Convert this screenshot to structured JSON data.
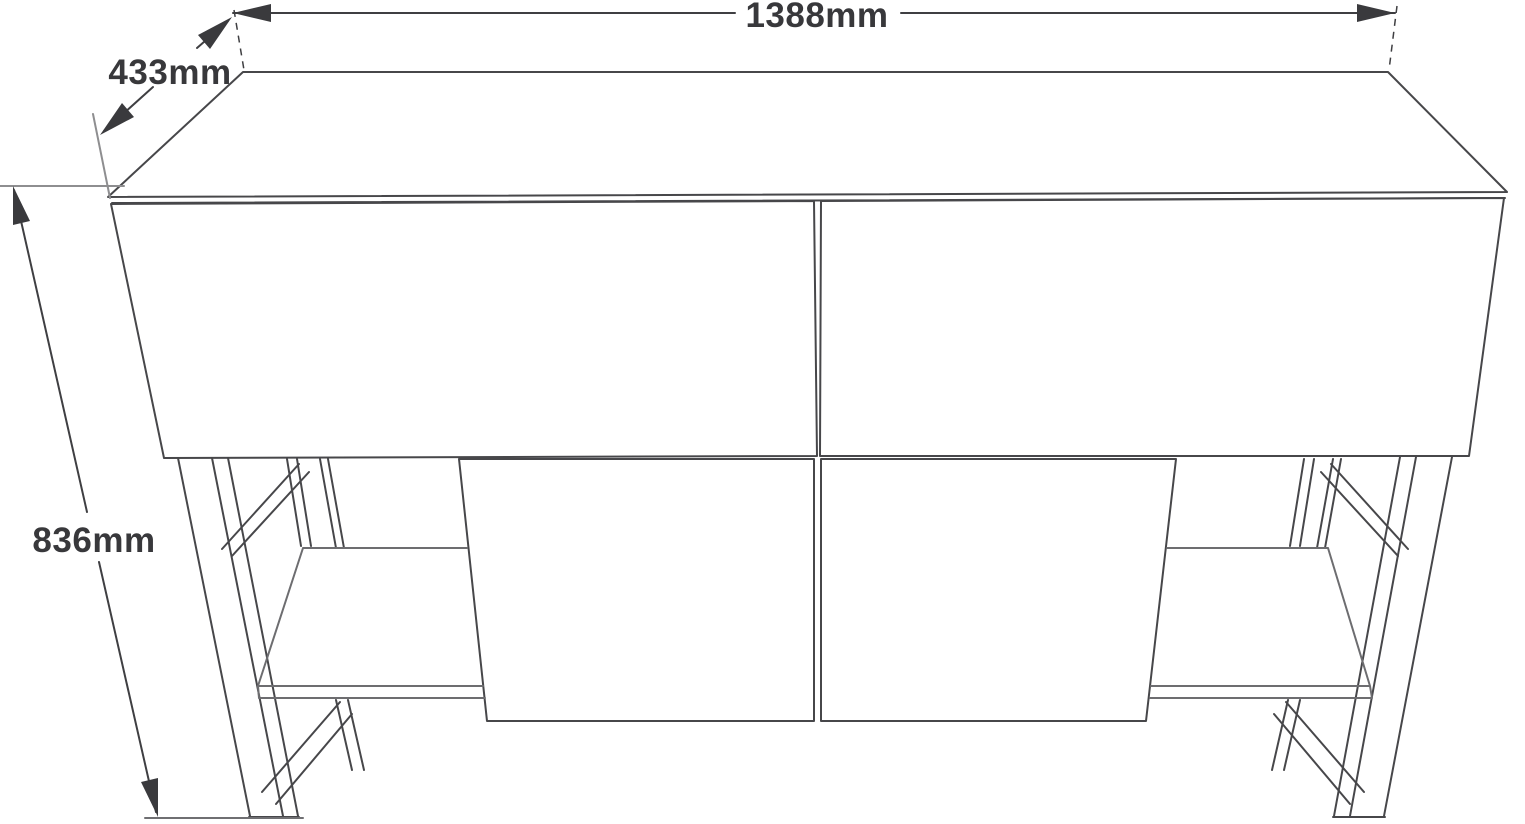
{
  "drawing": {
    "kind": "furniture-dimension-diagram",
    "subject": "console sideboard with two drawer fronts and A-frame legs",
    "labels": {
      "width": "1388mm",
      "depth": "433mm",
      "height": "836mm"
    },
    "colors": {
      "background": "#ffffff",
      "surface": "#ffffff",
      "outline": "#47474a",
      "secondary": "#6d6d70",
      "dimension": "#3f3f42",
      "arrow": "#3a3a3d",
      "text": "#38383b",
      "extension_gray": "#8e8e90",
      "extension_dark": "#6f6f72"
    }
  }
}
